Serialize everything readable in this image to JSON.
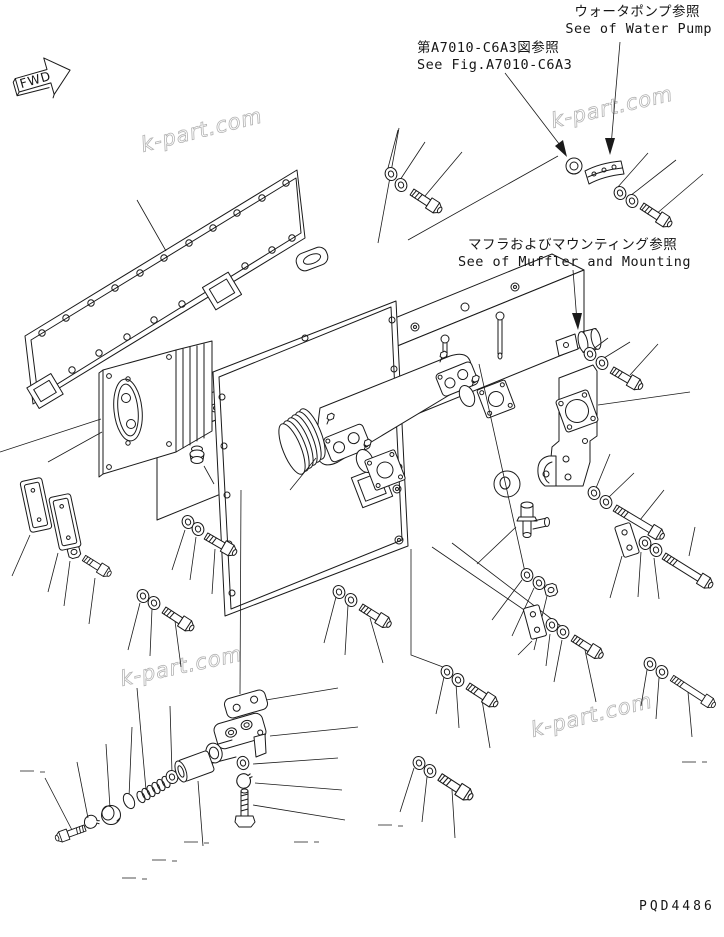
{
  "page": {
    "background": "#ffffff",
    "line_color": "#1a1a1a",
    "watermark_color": "#b3b3b3"
  },
  "annotations": {
    "water_pump": {
      "jp": "ウォータポンプ参照",
      "en": "See of Water Pump"
    },
    "fig_ref": {
      "jp": "第A7010-C6A3図参照",
      "en": "See Fig.A7010-C6A3"
    },
    "muffler": {
      "jp": "マフラおよびマウンティング参照",
      "en": "See of Muffler and Mounting"
    }
  },
  "fwd_marker": {
    "label": "FWD"
  },
  "watermark": {
    "text": "k-part.com"
  },
  "drawing_number": "PQD4486"
}
